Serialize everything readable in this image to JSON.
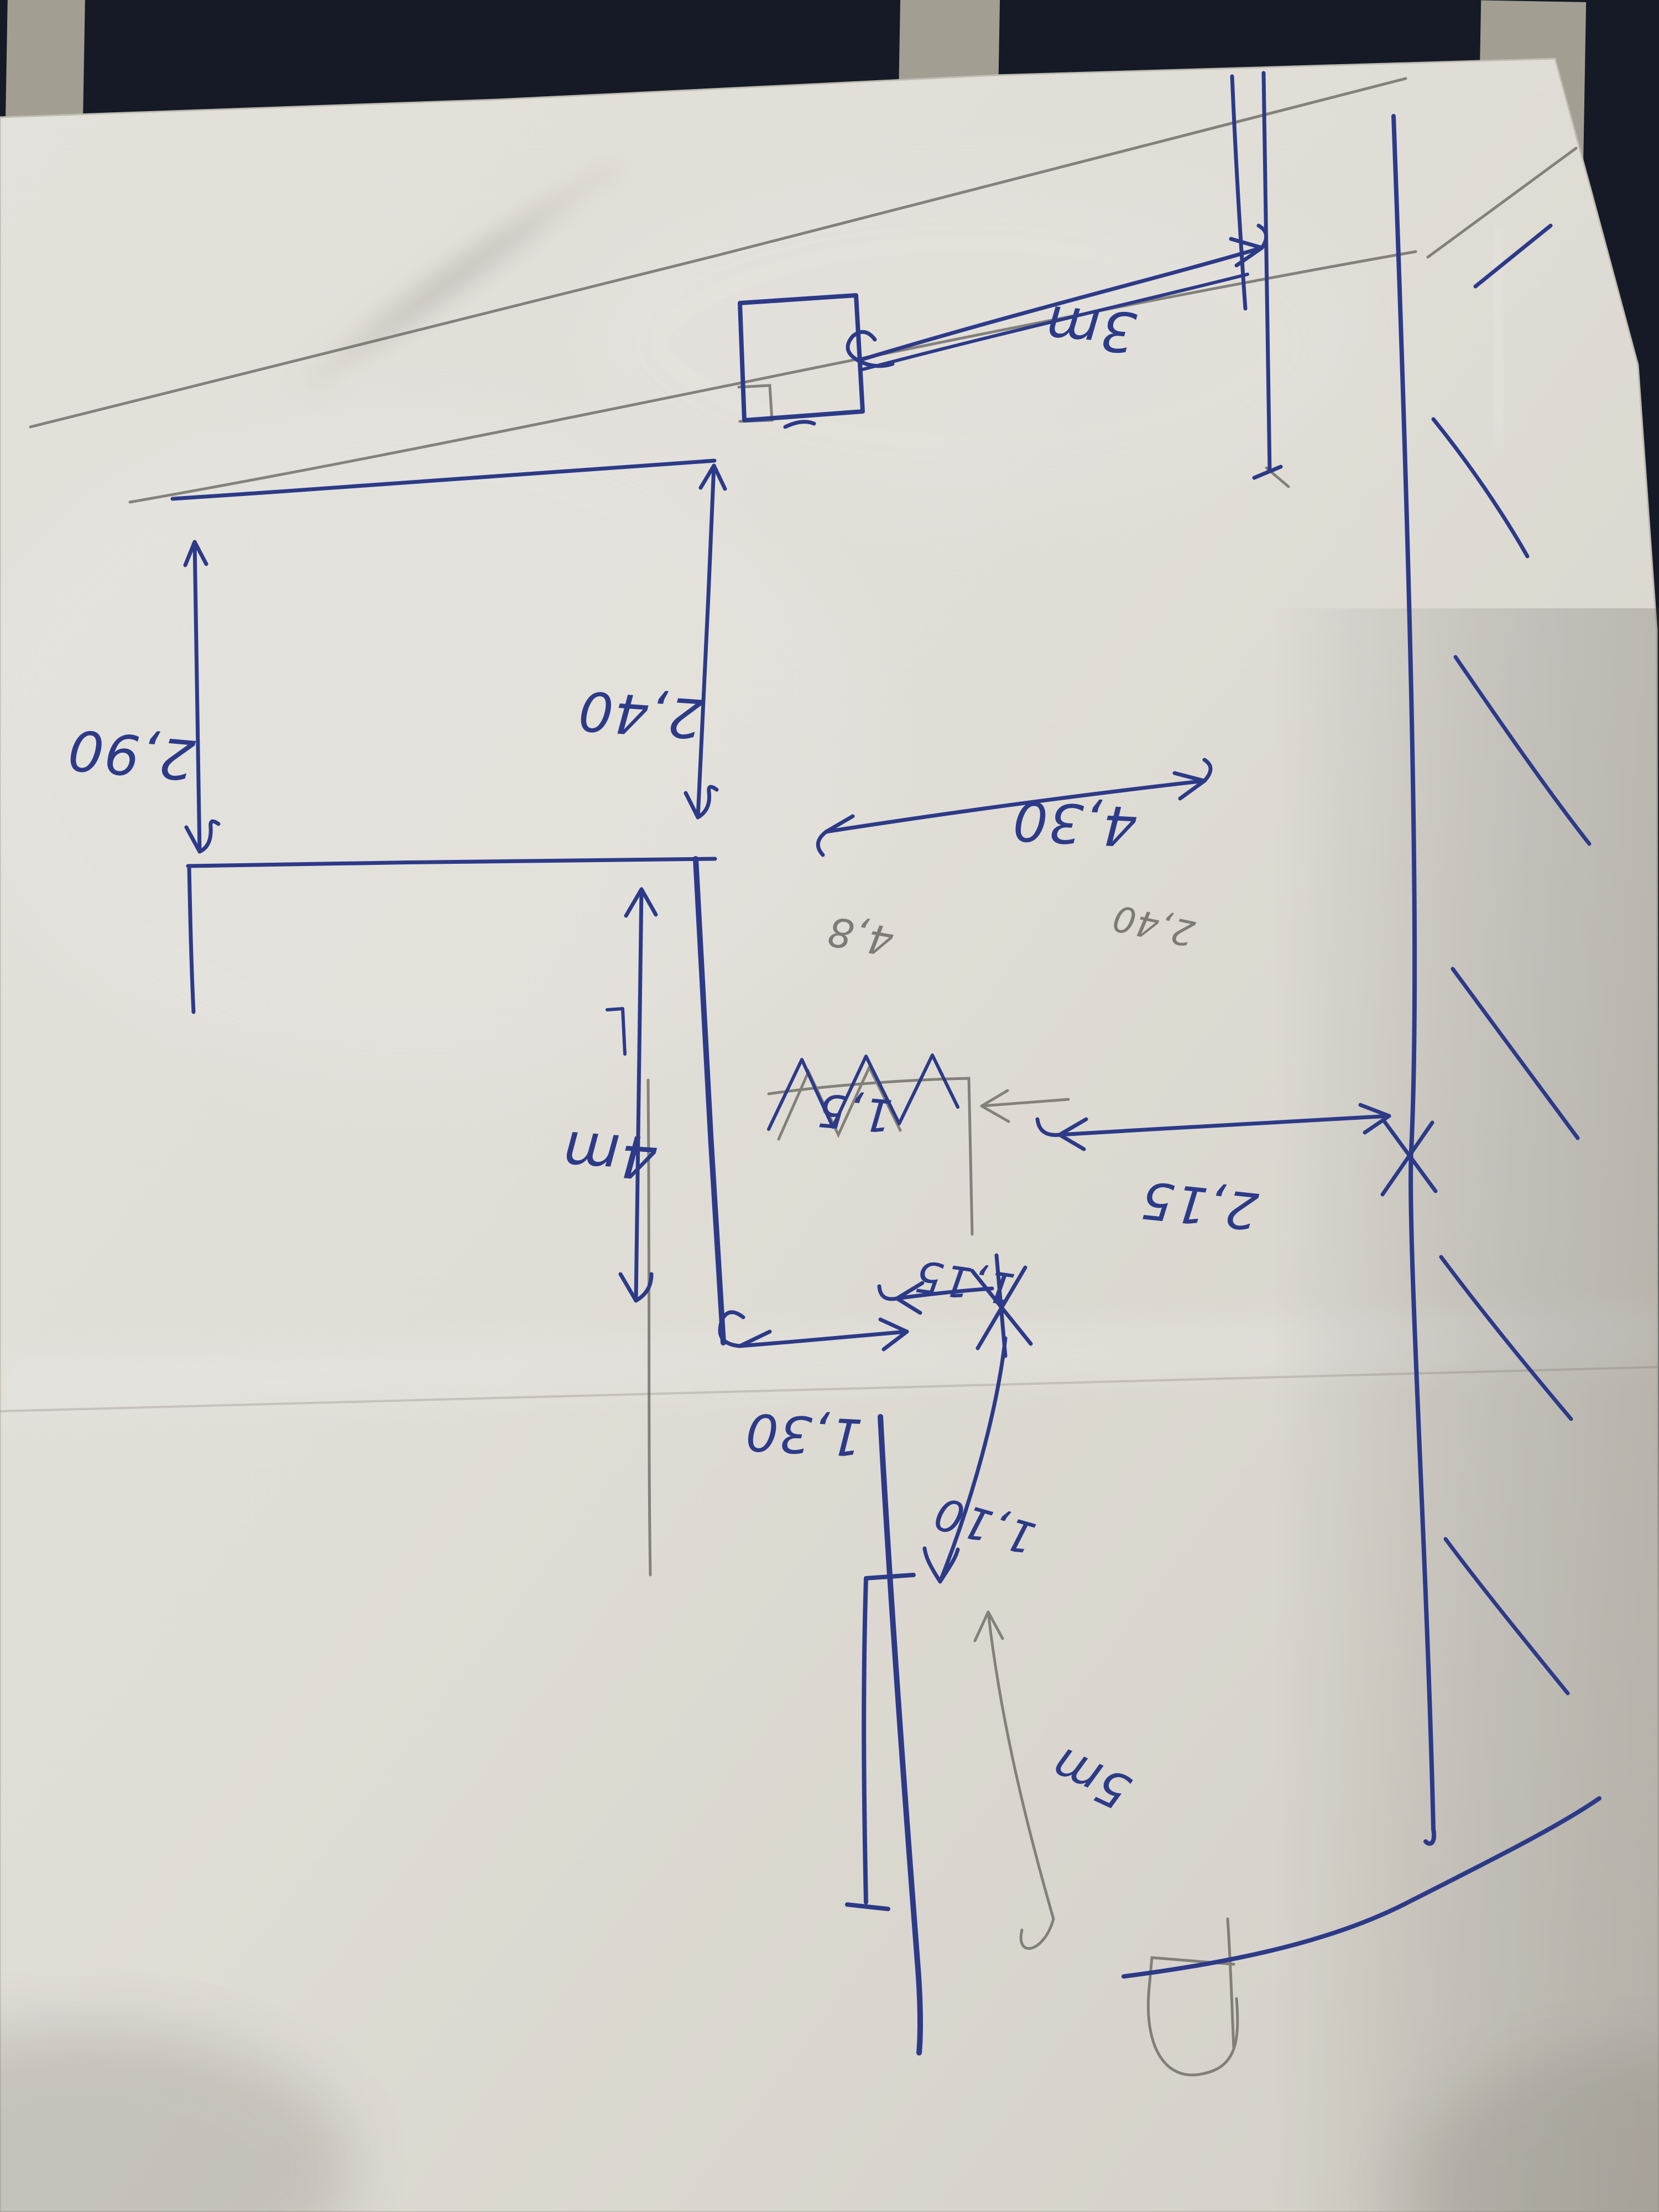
{
  "scene": {
    "description": "Photograph of a hand-drawn floor-plan sketch in blue ballpoint pen (with pencil construction lines) on a white sheet of paper, lying upside-down on dark navy fabric with cream stripes",
    "orientation_note": "All measurement labels are written rotated 180 degrees relative to the photo"
  },
  "colors": {
    "pen_blue": "#2c3a8e",
    "pen_blue_dark": "#263277",
    "pencil_gray": "#6f6d68",
    "paper": "#e9e6e0",
    "paper_shade": "#d8d4cc",
    "fabric_navy": "#171c2a",
    "fabric_stripe": "#ddd6c2"
  },
  "measurements": {
    "top_strip": "3m",
    "left_height": "2,90",
    "upper_room_height": "2,40",
    "upper_room_width": "4,30",
    "pencil_draft_a": "4,8",
    "pencil_draft_b": "2,40",
    "lower_room_height": "4m",
    "crossed_out_value": "1,5",
    "right_width": "2,15",
    "door_width": "1,15",
    "passage_width": "1,30",
    "corridor_width": "1,10",
    "bottom_length": "5m"
  }
}
